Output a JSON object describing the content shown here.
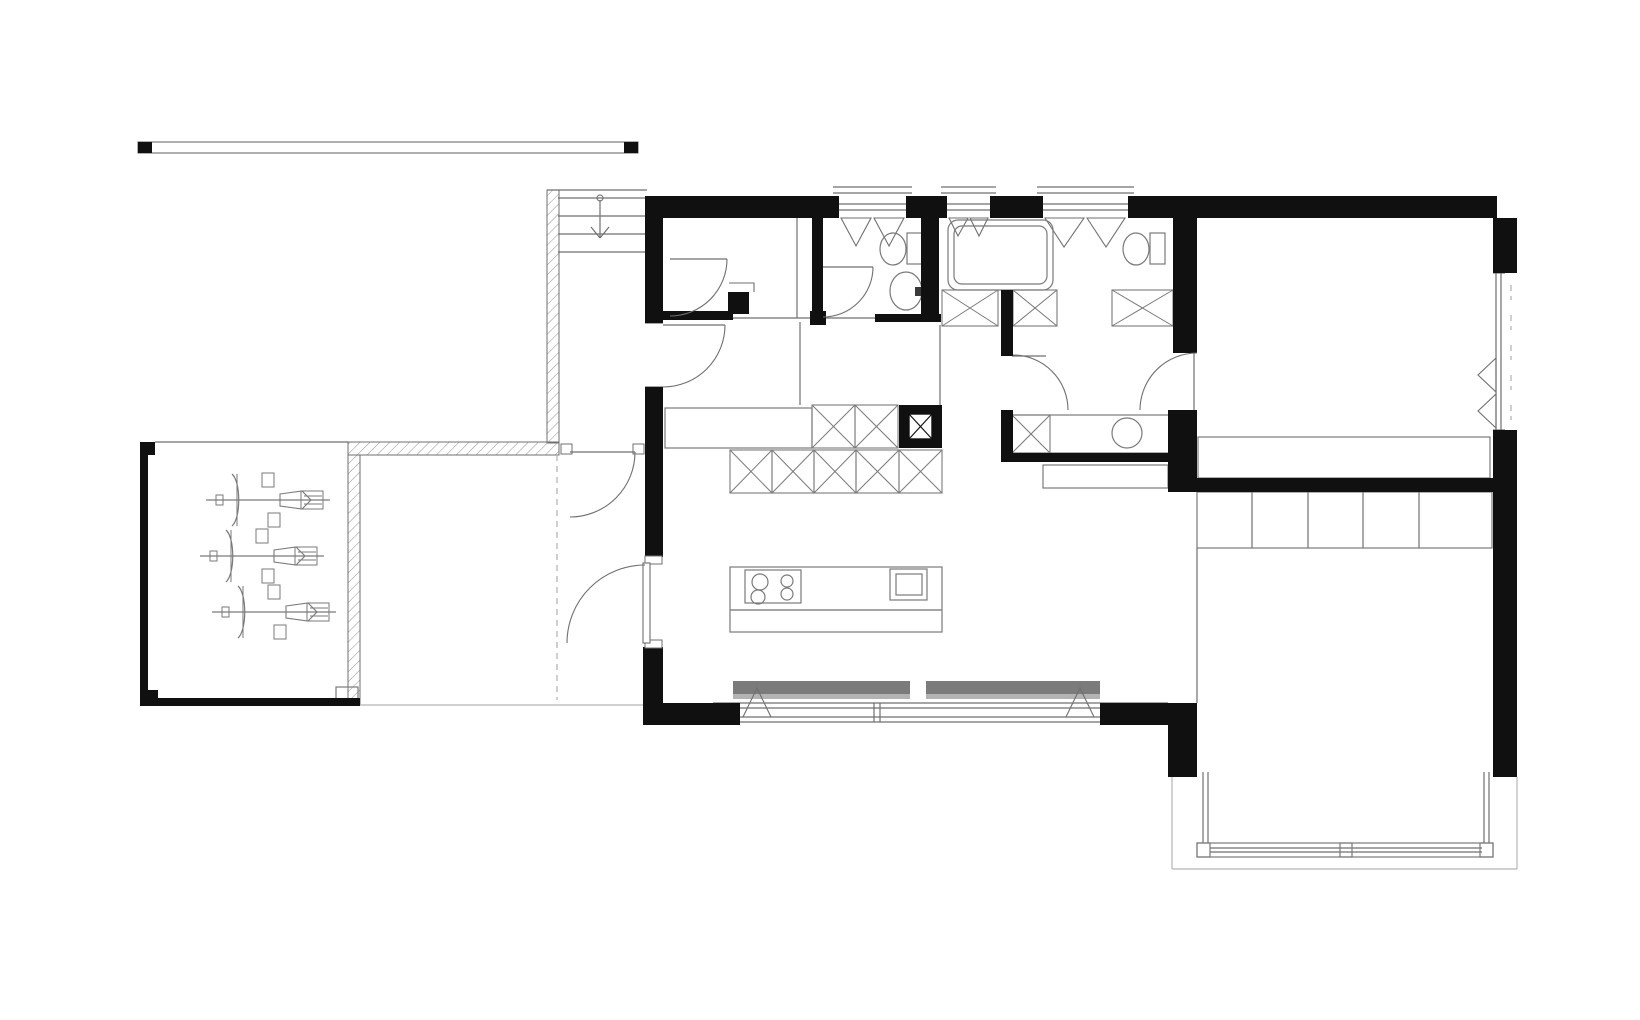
{
  "meta": {
    "drawing_type": "architectural-floor-plan",
    "style": "black-and-white CAD ground floor plan, no text labels visible"
  },
  "canvas": {
    "width": 1640,
    "height": 1020,
    "background": "#ffffff"
  },
  "palette": {
    "wall": "#101010",
    "line": "#6f6f6f",
    "fixture": "#7a7a7a",
    "light": "#b5b5b5",
    "hatch": "#9a9a9a",
    "shade_dark": "#7b7b7b",
    "shade_light": "#b3b3b3",
    "tap": "#3a3a3a"
  },
  "scale_bar": {
    "outline": [
      138,
      142,
      500,
      11
    ],
    "end_caps": [
      [
        138,
        142,
        14,
        11
      ],
      [
        624,
        142,
        14,
        11
      ]
    ]
  },
  "walls_black": [
    [
      645,
      196,
      194,
      22
    ],
    [
      906,
      196,
      41,
      22
    ],
    [
      990,
      196,
      53,
      22
    ],
    [
      1128,
      196,
      369,
      22
    ],
    [
      645,
      196,
      18,
      127
    ],
    [
      645,
      387,
      18,
      170
    ],
    [
      643,
      647,
      20,
      78
    ],
    [
      643,
      703,
      97,
      22
    ],
    [
      812,
      218,
      11,
      100
    ],
    [
      810,
      311,
      16,
      14
    ],
    [
      658,
      311,
      75,
      9
    ],
    [
      921,
      218,
      18,
      104
    ],
    [
      875,
      314,
      66,
      8
    ],
    [
      1001,
      290,
      12,
      66
    ],
    [
      1001,
      410,
      12,
      48
    ],
    [
      1001,
      453,
      176,
      9
    ],
    [
      1173,
      218,
      24,
      135
    ],
    [
      1168,
      410,
      29,
      82
    ],
    [
      1168,
      478,
      345,
      14
    ],
    [
      1100,
      703,
      97,
      22
    ],
    [
      1168,
      703,
      29,
      74
    ],
    [
      1493,
      218,
      24,
      55
    ],
    [
      1493,
      430,
      24,
      347
    ],
    [
      1173,
      720,
      24,
      57
    ],
    [
      140,
      442,
      15,
      13
    ],
    [
      140,
      442,
      8,
      263
    ],
    [
      140,
      690,
      18,
      16
    ],
    [
      140,
      698,
      220,
      8
    ],
    [
      728,
      292,
      21,
      22
    ],
    [
      899,
      405,
      43,
      43
    ]
  ],
  "scale_caps_are_walls": true,
  "hatched_walls": [
    [
      547,
      190,
      12,
      253
    ],
    [
      348,
      442,
      211,
      13
    ],
    [
      348,
      455,
      12,
      250
    ]
  ],
  "thin_lines": [
    [
      547,
      190,
      647,
      190
    ],
    [
      558,
      198,
      645,
      198
    ],
    [
      558,
      216,
      645,
      216
    ],
    [
      558,
      234,
      645,
      234
    ],
    [
      558,
      252,
      645,
      252
    ],
    [
      600,
      200,
      600,
      238
    ],
    [
      591,
      227,
      600,
      238
    ],
    [
      609,
      227,
      600,
      238
    ],
    [
      155,
      442,
      348,
      442
    ],
    [
      797,
      218,
      797,
      318
    ],
    [
      733,
      318,
      812,
      318
    ],
    [
      823,
      318,
      875,
      318
    ],
    [
      645,
      323,
      663,
      323
    ],
    [
      645,
      387,
      663,
      387
    ],
    [
      800,
      322,
      800,
      405
    ],
    [
      940,
      325,
      940,
      405
    ],
    [
      1012,
      356,
      1046,
      356
    ],
    [
      1197,
      548,
      1197,
      703
    ],
    [
      730,
      610,
      942,
      610
    ],
    [
      1252,
      492,
      1252,
      548
    ],
    [
      1308,
      492,
      1308,
      548
    ],
    [
      1363,
      492,
      1363,
      548
    ],
    [
      1419,
      492,
      1419,
      548
    ],
    [
      833,
      187,
      912,
      187
    ],
    [
      833,
      193,
      912,
      193
    ],
    [
      839,
      204,
      906,
      204
    ],
    [
      839,
      210,
      906,
      210
    ],
    [
      941,
      187,
      996,
      187
    ],
    [
      941,
      193,
      996,
      193
    ],
    [
      947,
      204,
      990,
      204
    ],
    [
      947,
      210,
      990,
      210
    ],
    [
      1037,
      187,
      1134,
      187
    ],
    [
      1037,
      193,
      1134,
      193
    ],
    [
      1043,
      204,
      1128,
      204
    ],
    [
      1043,
      210,
      1128,
      210
    ],
    [
      1496,
      273,
      1496,
      430
    ],
    [
      1501,
      273,
      1501,
      430
    ],
    [
      1493,
      273,
      1505,
      273
    ],
    [
      1493,
      430,
      1505,
      430
    ],
    [
      713,
      703,
      1168,
      703
    ],
    [
      713,
      708,
      1168,
      708
    ],
    [
      713,
      717,
      1168,
      717
    ],
    [
      713,
      722,
      1168,
      722
    ],
    [
      713,
      703,
      713,
      722
    ],
    [
      718,
      703,
      718,
      722
    ],
    [
      874,
      703,
      874,
      722
    ],
    [
      880,
      703,
      880,
      722
    ],
    [
      1163,
      703,
      1163,
      722
    ],
    [
      1168,
      703,
      1168,
      722
    ],
    [
      1203,
      772,
      1203,
      843
    ],
    [
      1208,
      772,
      1208,
      843
    ],
    [
      1484,
      772,
      1484,
      843
    ],
    [
      1489,
      772,
      1489,
      843
    ],
    [
      1210,
      848,
      1482,
      848
    ],
    [
      1210,
      852,
      1482,
      852
    ]
  ],
  "light_lines": [
    [
      360,
      705,
      643,
      705
    ],
    [
      1172,
      777,
      1172,
      869
    ],
    [
      1172,
      869,
      1517,
      869
    ],
    [
      1517,
      869,
      1517,
      777
    ]
  ],
  "dash_lines": [
    [
      557,
      455,
      557,
      700
    ],
    [
      1511,
      285,
      1511,
      300
    ],
    [
      1511,
      315,
      1511,
      330
    ],
    [
      1511,
      345,
      1511,
      360
    ],
    [
      1511,
      375,
      1511,
      390
    ],
    [
      1511,
      405,
      1511,
      420
    ]
  ],
  "triangles": [
    [
      841,
      218,
      856,
      246,
      871,
      218
    ],
    [
      874,
      218,
      889,
      246,
      904,
      218
    ],
    [
      949,
      218,
      958,
      236,
      968,
      218
    ],
    [
      970,
      218,
      979,
      236,
      988,
      218
    ],
    [
      1045,
      218,
      1064,
      247,
      1084,
      218
    ],
    [
      1087,
      218,
      1106,
      247,
      1125,
      218
    ],
    [
      1496,
      358,
      1478,
      375,
      1496,
      392
    ],
    [
      1496,
      394,
      1478,
      411,
      1496,
      428
    ]
  ],
  "polylines": [
    [
      743,
      717,
      757,
      688,
      771,
      717
    ],
    [
      1066,
      717,
      1080,
      688,
      1094,
      717
    ],
    [
      729,
      283,
      754,
      283,
      754,
      292
    ]
  ],
  "gray_bar": {
    "dark": [
      733,
      681,
      367,
      13
    ],
    "light": [
      733,
      694,
      367,
      5
    ],
    "gap": [
      910,
      681,
      16,
      18
    ]
  },
  "doors": [
    {
      "name": "door-office",
      "leaf": [
        670,
        259,
        727,
        259
      ],
      "arc": "M727,259 A57,57 0 0 1 670,316"
    },
    {
      "name": "door-hall",
      "leaf": [
        663,
        325,
        725,
        325
      ],
      "arc": "M725,325 A62,62 0 0 1 663,387"
    },
    {
      "name": "door-wc",
      "leaf": [
        823,
        267,
        873,
        267
      ],
      "arc": "M873,267 A50,50 0 0 1 823,317"
    },
    {
      "name": "door-bathroom",
      "arc": "M1013,355 A55,55 0 0 1 1068,410"
    },
    {
      "name": "door-bedroom",
      "leaf": [
        1194,
        353,
        1194,
        410
      ],
      "arc": "M1197,353 A57,57 0 0 0 1140,410"
    },
    {
      "name": "door-vestibule",
      "leaf": [
        570,
        452,
        635,
        452
      ],
      "arc": "M635,452 A65,65 0 0 1 570,517"
    },
    {
      "name": "door-entry",
      "arc": "M645,565 A78,78 0 0 0 567,643",
      "leaf_rect": [
        643,
        563,
        7,
        80
      ]
    }
  ],
  "white_jambs": [
    [
      561,
      444,
      11,
      10
    ],
    [
      633,
      444,
      11,
      10
    ],
    [
      645,
      556,
      17,
      8
    ],
    [
      645,
      640,
      17,
      8
    ]
  ],
  "x_boxes": [
    [
      942,
      290,
      56,
      36
    ],
    [
      1013,
      290,
      44,
      36
    ],
    [
      1112,
      290,
      61,
      36
    ],
    [
      1012,
      415,
      38,
      38
    ],
    [
      812,
      405,
      43,
      43
    ],
    [
      855,
      405,
      43,
      43
    ],
    [
      730,
      450,
      42,
      43
    ],
    [
      772,
      450,
      42,
      43
    ],
    [
      814,
      450,
      42,
      43
    ],
    [
      856,
      450,
      43,
      43
    ],
    [
      899,
      450,
      43,
      43
    ]
  ],
  "chimney_inner": [
    909,
    414,
    23,
    25
  ],
  "rects_stroke": [
    [
      665,
      408,
      147,
      40
    ],
    [
      1012,
      415,
      165,
      38
    ],
    [
      1043,
      465,
      125,
      23
    ],
    [
      1198,
      437,
      292,
      41
    ],
    [
      1197,
      492,
      295,
      56
    ],
    [
      336,
      687,
      22,
      16
    ],
    [
      730,
      567,
      212,
      65
    ],
    [
      745,
      570,
      56,
      33
    ],
    [
      890,
      569,
      37,
      31
    ],
    [
      896,
      574,
      26,
      21
    ],
    [
      907,
      233,
      15,
      31
    ],
    [
      1150,
      233,
      15,
      31
    ],
    [
      1197,
      843,
      296,
      14
    ],
    [
      1197,
      843,
      13,
      14
    ],
    [
      1340,
      843,
      12,
      14
    ],
    [
      1480,
      843,
      13,
      14
    ],
    [
      138,
      142,
      500,
      11
    ]
  ],
  "round_rects": [
    [
      948,
      220,
      105,
      70,
      10
    ],
    [
      954,
      226,
      93,
      58,
      8
    ]
  ],
  "ellipses": [
    [
      893,
      249,
      13,
      16
    ],
    [
      1136,
      249,
      13,
      16
    ],
    [
      906,
      291,
      16,
      19
    ]
  ],
  "circles": [
    [
      1127,
      433,
      15
    ],
    [
      760,
      582,
      8
    ],
    [
      758,
      597,
      7
    ],
    [
      787,
      581,
      6
    ],
    [
      787,
      594,
      6
    ],
    [
      600,
      198,
      3
    ]
  ],
  "tap_rect": [
    915,
    287,
    9,
    9
  ],
  "bicycles": {
    "centers": [
      [
        268,
        500
      ],
      [
        262,
        556
      ],
      [
        274,
        612
      ]
    ]
  }
}
